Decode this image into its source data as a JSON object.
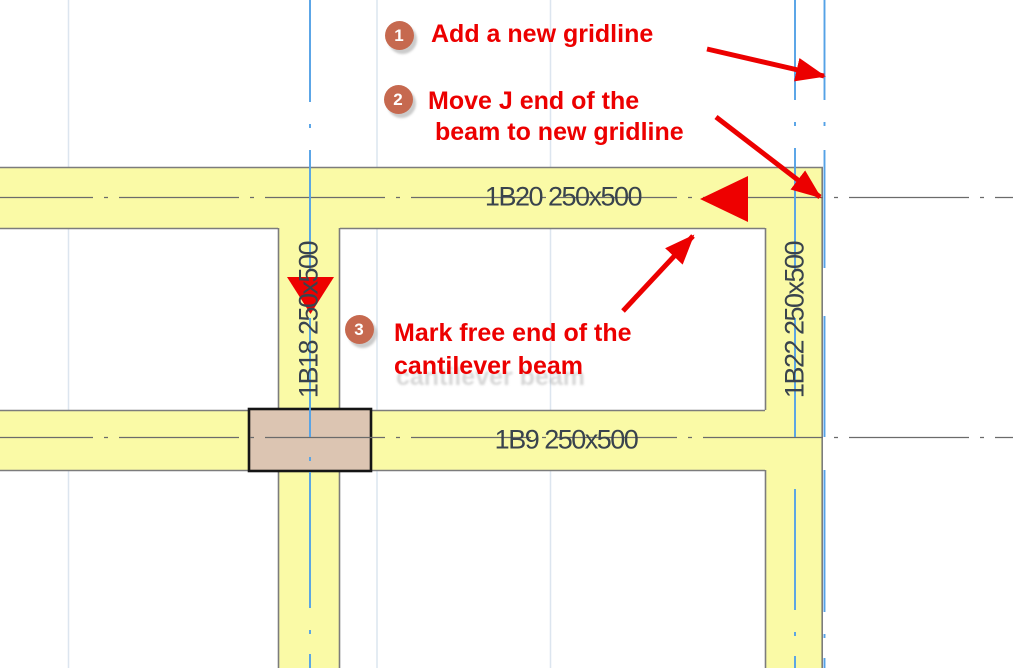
{
  "drawing": {
    "beam_labels": {
      "top_beam": "1B20 250x500",
      "middle_vertical_beam": "1B18 250x500",
      "right_vertical_beam": "1B22 250x500",
      "bottom_beam": "1B9 250x500"
    },
    "colors": {
      "beam_fill": "#FAFAA6",
      "beam_edge": "#7C7C7C",
      "column_fill": "#DCC5B2",
      "column_border": "#151515",
      "gridline_blue": "#54A2E6",
      "gridline_gray": "#6B6B6B",
      "minor_gridline": "#DCE5EF",
      "label_text": "#39434D",
      "annotation_red": "#EC0000",
      "step_badge": "#C6694F"
    }
  },
  "annotations": {
    "steps": [
      {
        "number": "1",
        "lines": [
          "Add a new gridline"
        ]
      },
      {
        "number": "2",
        "lines": [
          "Move J end of the",
          "beam to new gridline"
        ]
      },
      {
        "number": "3",
        "lines": [
          "Mark free end of the",
          "cantilever beam"
        ]
      }
    ]
  }
}
